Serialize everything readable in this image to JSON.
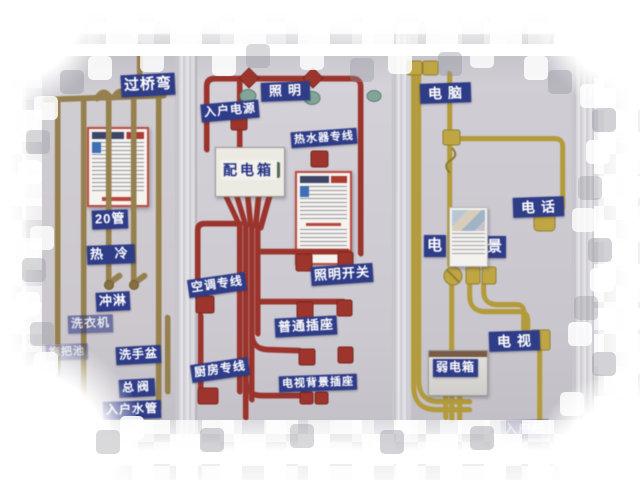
{
  "plumbing": {
    "labels": [
      {
        "text": "过桥弯"
      },
      {
        "text": "20管"
      },
      {
        "text": "热 冷"
      },
      {
        "text": "冲淋"
      },
      {
        "text": "洗衣机"
      },
      {
        "text": "拖把池"
      },
      {
        "text": "洗手盆"
      },
      {
        "text": "总阀"
      },
      {
        "text": "入户水管"
      }
    ]
  },
  "power": {
    "labels": [
      {
        "text": "入户电源"
      },
      {
        "text": "照明"
      },
      {
        "text": "热水器专线"
      },
      {
        "text": "配电箱"
      },
      {
        "text": "空调专线"
      },
      {
        "text": "照明开关"
      },
      {
        "text": "普通插座"
      },
      {
        "text": "厨房专线"
      },
      {
        "text": "电视背景插座"
      }
    ]
  },
  "low_voltage": {
    "labels": [
      {
        "text": "电脑"
      },
      {
        "text": "电话"
      },
      {
        "text": "电"
      },
      {
        "text": "景"
      },
      {
        "text": "电视"
      },
      {
        "text": "弱电箱"
      },
      {
        "text": "入户线"
      }
    ]
  },
  "colors": {
    "wall": "#cbc8d0",
    "pipe_tan": "#97804a",
    "conduit_red": "#a5332a",
    "conduit_yellow": "#c2a53b",
    "label_blue": "#2e3c8e",
    "poster_red": "#c0443a"
  }
}
